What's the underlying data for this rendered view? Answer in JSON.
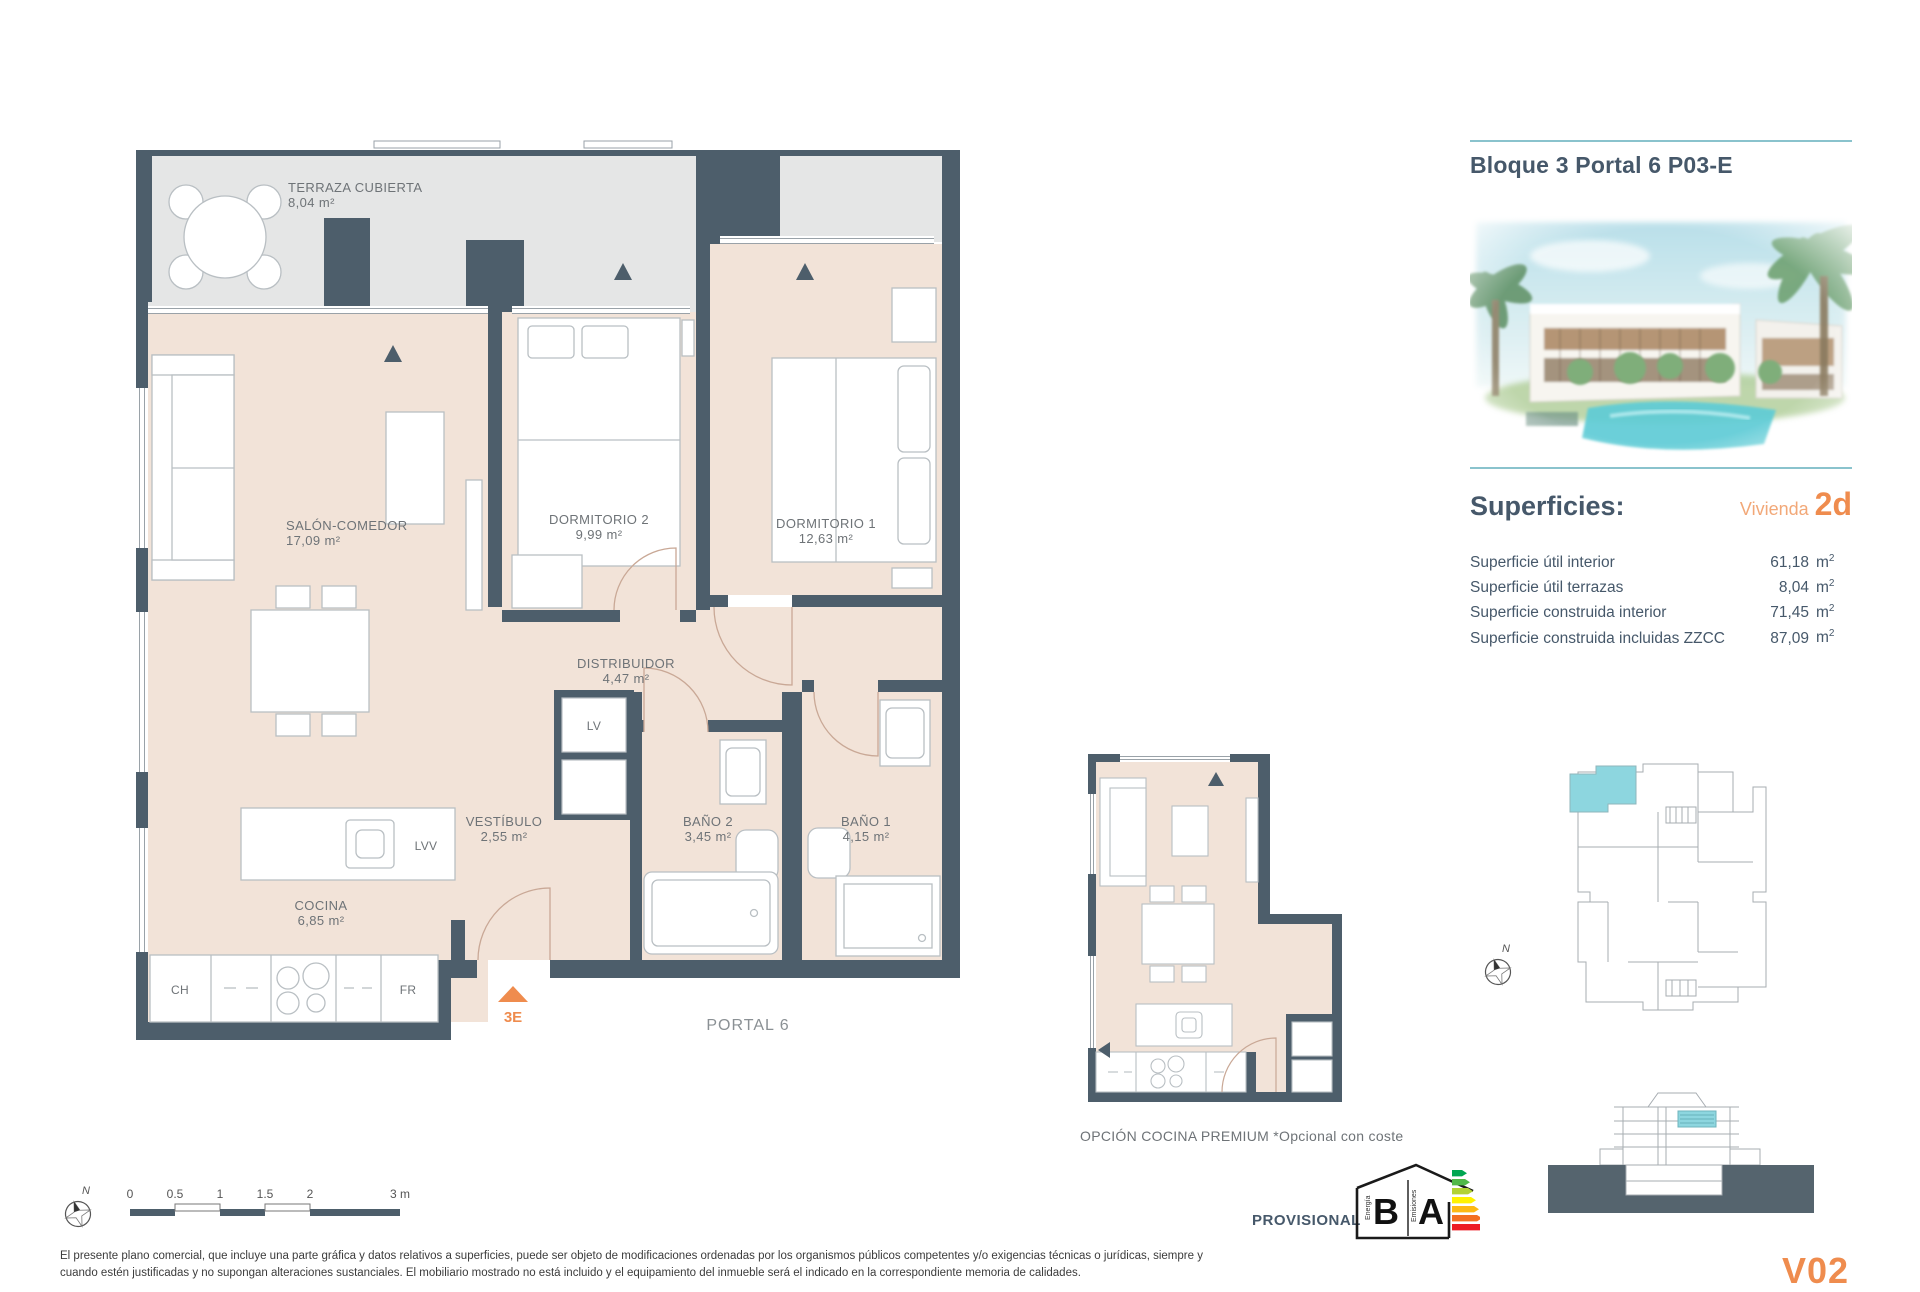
{
  "header": {
    "title": "Bloque 3 Portal 6 P03-E"
  },
  "superficies": {
    "heading": "Superficies:",
    "vivienda_label": "Vivienda",
    "vivienda_code": "2d",
    "rows": [
      {
        "label": "Superficie útil interior",
        "value": "61,18",
        "unit_base": "m",
        "unit_exp": "2"
      },
      {
        "label": "Superficie útil terrazas",
        "value": "8,04",
        "unit_base": "m",
        "unit_exp": "2"
      },
      {
        "label": "Superficie construida interior",
        "value": "71,45",
        "unit_base": "m",
        "unit_exp": "2"
      },
      {
        "label": "Superficie construida incluidas ZZCC",
        "value": "87,09",
        "unit_base": "m",
        "unit_exp": "2"
      }
    ]
  },
  "plan": {
    "terraza": {
      "name": "TERRAZA CUBIERTA",
      "area": "8,04 m²"
    },
    "salon": {
      "name": "SALÓN-COMEDOR",
      "area": "17,09 m²"
    },
    "dormitorio2": {
      "name": "DORMITORIO 2",
      "area": "9,99 m²"
    },
    "dormitorio1": {
      "name": "DORMITORIO 1",
      "area": "12,63 m²"
    },
    "distribuidor": {
      "name": "DISTRIBUIDOR",
      "area": "4,47 m²"
    },
    "vestibulo": {
      "name": "VESTÍBULO",
      "area": "2,55 m²"
    },
    "bano2": {
      "name": "BAÑO 2",
      "area": "3,45 m²"
    },
    "bano1": {
      "name": "BAÑO 1",
      "area": "4,15 m²"
    },
    "cocina": {
      "name": "COCINA",
      "area": "6,85 m²"
    },
    "labels": {
      "ch": "CH",
      "fr": "FR",
      "lv": "LV",
      "lvv": "LVV"
    },
    "entrance": "3E",
    "portal": "PORTAL 6"
  },
  "premium": {
    "caption": "OPCIÓN COCINA PREMIUM *Opcional con coste"
  },
  "scale_bar": {
    "ticks": [
      "0",
      "0.5",
      "1",
      "1.5",
      "2",
      "3 m"
    ]
  },
  "compass": {
    "north": "N"
  },
  "energy": {
    "provisional": "PROVISIONAL",
    "energy_letter": "B",
    "emissions_letter": "A",
    "energy_label": "Energía",
    "emissions_label": "Emisiones"
  },
  "footer": {
    "disclaimer_line1": "El presente plano comercial, que incluye una parte gráfica y datos relativos a superficies, puede ser objeto de modificaciones ordenadas por los organismos públicos competentes y/o exigencias técnicas o jurídicas, siempre y",
    "disclaimer_line2": "cuando estén justificadas y no supongan alteraciones sustanciales. El mobiliario mostrado no está incluido y el equipamiento del inmueble será el indicado en la correspondiente memoria de calidades.",
    "version": "V02"
  },
  "colors": {
    "wall": "#4d5e6b",
    "floor": "#f2e3d8",
    "terrace": "#e5e6e6",
    "unit_highlight": "#8dd6df",
    "accent_orange": "#ef8c4e",
    "divider_teal": "#8ac3cd",
    "title_text": "#46586a",
    "plan_text": "#6e7377"
  }
}
